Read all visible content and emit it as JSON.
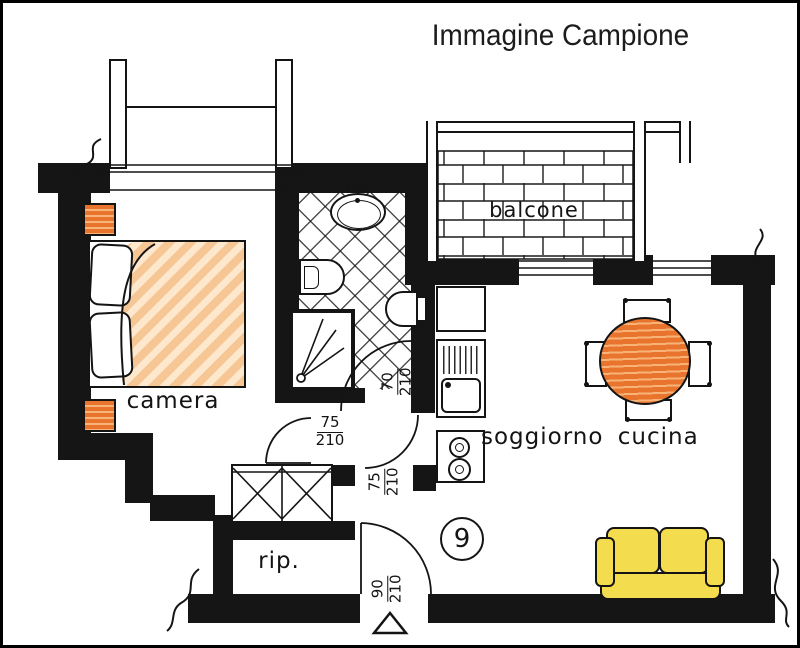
{
  "title": "Immagine Campione",
  "apartment_number": "9",
  "rooms": {
    "bedroom": {
      "label": "camera"
    },
    "balcony": {
      "label": "balcone"
    },
    "living_kitchen": {
      "label": "soggiorno cucina"
    },
    "storage": {
      "label": "rip."
    }
  },
  "door_dimensions": {
    "bedroom_door": {
      "num": "75",
      "den": "210"
    },
    "bathroom_door": {
      "num": "70",
      "den": "210"
    },
    "living_door": {
      "num": "75",
      "den": "210"
    },
    "entrance_door": {
      "num": "90",
      "den": "210"
    }
  },
  "colors": {
    "wall": "#151515",
    "line": "#141414",
    "bed_blanket_stripe": "#f6c795",
    "bed_blanket_light": "#fde8cd",
    "wood_orange": "#e8742e",
    "wood_orange_light": "#f8b478",
    "sofa_yellow": "#f3dd4e"
  }
}
